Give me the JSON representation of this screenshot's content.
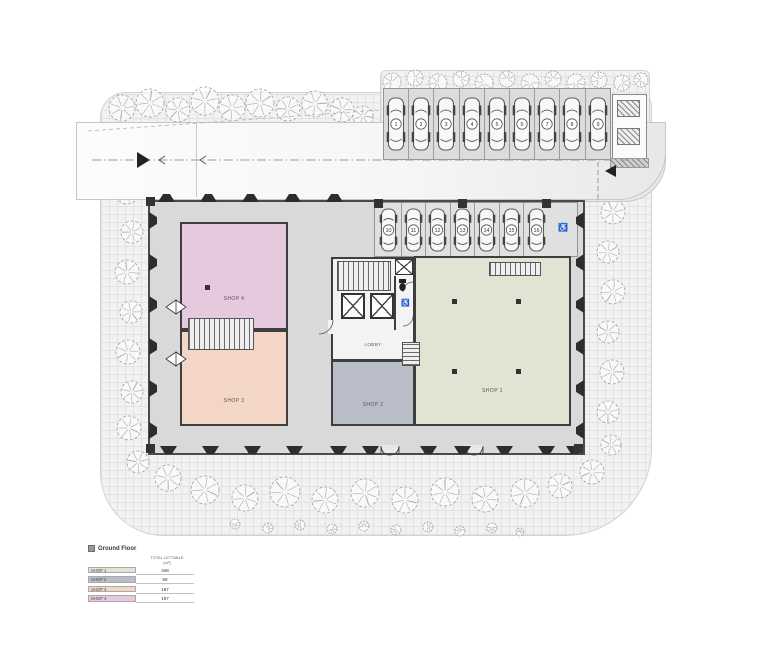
{
  "legend": {
    "title": "Ground Floor",
    "header_line1": "TOTAL LETTABLE",
    "header_line2": "[m²]",
    "rows": [
      {
        "label": "SHOP 1",
        "value": "348",
        "color": "#dfe4d3"
      },
      {
        "label": "SHOP 2",
        "value": "68",
        "color": "#b8bdc7"
      },
      {
        "label": "SHOP 3",
        "value": "187",
        "color": "#f3d6c6"
      },
      {
        "label": "SHOP 4",
        "value": "197",
        "color": "#e6c9de"
      }
    ]
  },
  "rooms": [
    {
      "id": "shop1",
      "label": "SHOP 1",
      "color": "#dfe4d3"
    },
    {
      "id": "shop2",
      "label": "SHOP 2",
      "color": "#b8bdc7"
    },
    {
      "id": "shop3",
      "label": "SHOP 3",
      "color": "#f3d6c6"
    },
    {
      "id": "shop4",
      "label": "SHOP 4",
      "color": "#e6c9de"
    }
  ],
  "core": {
    "lobby_label": "LOBBY"
  },
  "parking": {
    "top_row": {
      "numbers": [
        "1",
        "2",
        "3",
        "4",
        "5",
        "6",
        "7",
        "8",
        "9"
      ]
    },
    "inner_row": {
      "numbers": [
        "10",
        "11",
        "12",
        "13",
        "14",
        "15",
        "16"
      ],
      "accessible_icon": "wheelchair-icon",
      "accessible_glyph": "♿"
    }
  },
  "colors": {
    "wall": "#4a4a4a",
    "slab": "#d9d9d9",
    "paving": "#f2f2f2",
    "car_body": "#f8f8f8",
    "pilaster": "#2d2d2d"
  },
  "trees": [
    [
      122,
      108,
      13
    ],
    [
      150,
      103,
      14
    ],
    [
      178,
      110,
      12
    ],
    [
      205,
      101,
      14
    ],
    [
      232,
      108,
      13
    ],
    [
      260,
      103,
      14
    ],
    [
      288,
      109,
      12
    ],
    [
      315,
      104,
      13
    ],
    [
      342,
      110,
      12
    ],
    [
      363,
      116,
      10
    ],
    [
      130,
      150,
      11
    ],
    [
      127,
      192,
      12
    ],
    [
      132,
      232,
      11
    ],
    [
      127,
      272,
      12
    ],
    [
      131,
      312,
      11
    ],
    [
      128,
      352,
      12
    ],
    [
      132,
      392,
      11
    ],
    [
      129,
      428,
      12
    ],
    [
      138,
      462,
      11
    ],
    [
      168,
      478,
      13
    ],
    [
      205,
      490,
      14
    ],
    [
      245,
      498,
      13
    ],
    [
      285,
      492,
      15
    ],
    [
      325,
      500,
      13
    ],
    [
      365,
      493,
      14
    ],
    [
      405,
      500,
      13
    ],
    [
      445,
      492,
      14
    ],
    [
      485,
      499,
      13
    ],
    [
      525,
      493,
      14
    ],
    [
      560,
      486,
      12
    ],
    [
      592,
      472,
      12
    ],
    [
      609,
      172,
      11
    ],
    [
      613,
      212,
      12
    ],
    [
      608,
      252,
      11
    ],
    [
      613,
      292,
      12
    ],
    [
      608,
      332,
      11
    ],
    [
      612,
      372,
      12
    ],
    [
      608,
      412,
      11
    ],
    [
      611,
      445,
      10
    ]
  ],
  "shrubs": [
    [
      235,
      524,
      5
    ],
    [
      268,
      528,
      5
    ],
    [
      300,
      525,
      5
    ],
    [
      332,
      529,
      5
    ],
    [
      364,
      526,
      5
    ],
    [
      396,
      530,
      5
    ],
    [
      428,
      527,
      5
    ],
    [
      460,
      531,
      5
    ],
    [
      492,
      528,
      5
    ],
    [
      520,
      532,
      4
    ]
  ],
  "hedge": [
    [
      392,
      82,
      9
    ],
    [
      415,
      78,
      8
    ],
    [
      438,
      83,
      9
    ],
    [
      461,
      79,
      8
    ],
    [
      484,
      83,
      9
    ],
    [
      507,
      79,
      8
    ],
    [
      530,
      83,
      9
    ],
    [
      553,
      79,
      8
    ],
    [
      576,
      83,
      9
    ],
    [
      599,
      80,
      8
    ],
    [
      622,
      83,
      8
    ],
    [
      641,
      80,
      7
    ]
  ]
}
